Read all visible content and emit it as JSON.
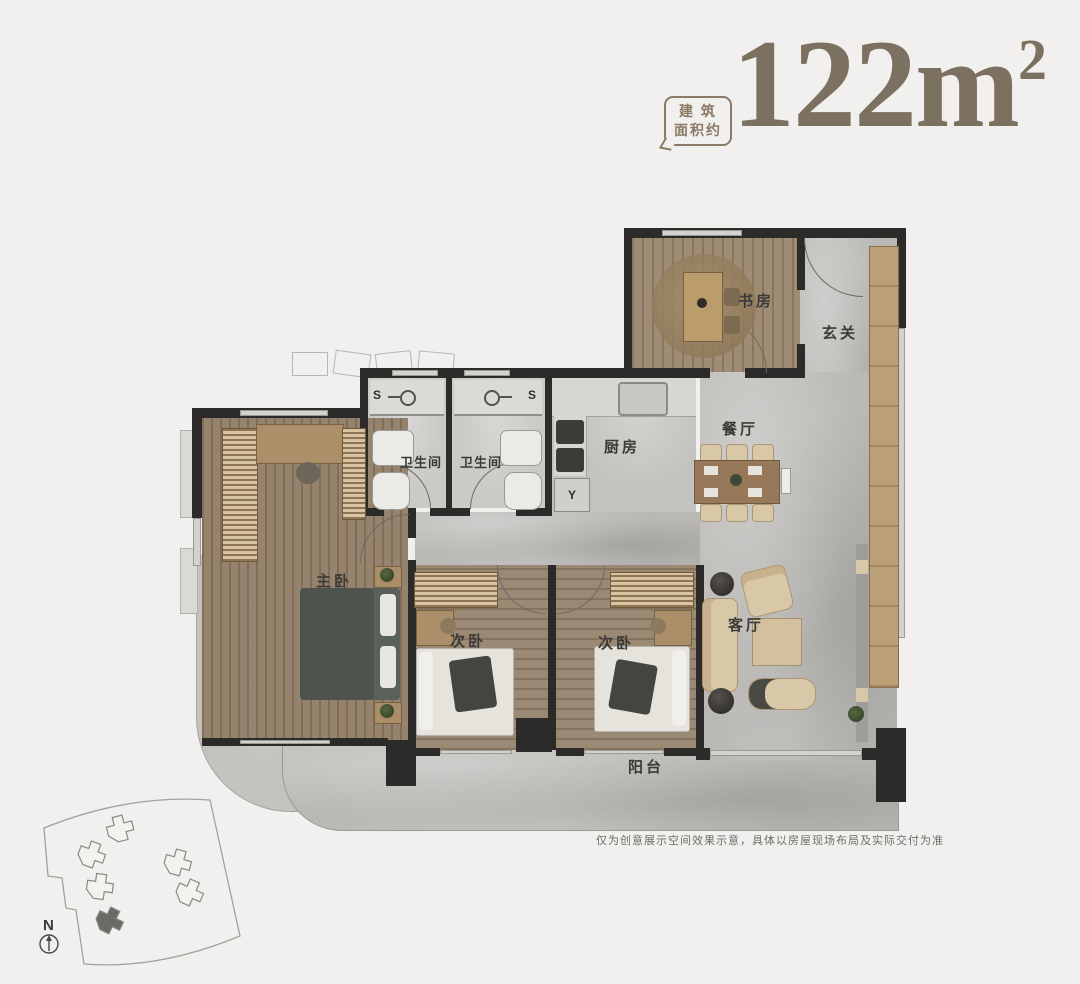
{
  "header": {
    "area_label_line1": "建 筑",
    "area_label_line2": "面积约",
    "area_value": "122m",
    "area_superscript": "2"
  },
  "rooms": {
    "study": "书房",
    "foyer": "玄关",
    "dining": "餐厅",
    "kitchen": "厨房",
    "bathroom_1": "卫生间",
    "bathroom_2": "卫生间",
    "master_bedroom": "主卧",
    "bedroom_2": "次卧",
    "bedroom_3": "次卧",
    "living": "客厅",
    "balcony": "阳台"
  },
  "markers": {
    "shower_1": "S",
    "shower_2": "S",
    "laundry": "Y",
    "compass_north": "N"
  },
  "footer": {
    "disclaimer": "仅为创意展示空间效果示意，具体以房屋现场布局及实际交付为准"
  },
  "colors": {
    "accent": "#7c7160",
    "wall": "#2c2b29",
    "wood_floor": "#94806a",
    "marble_floor": "#b9b8b5",
    "background": "#f2f0ee"
  }
}
